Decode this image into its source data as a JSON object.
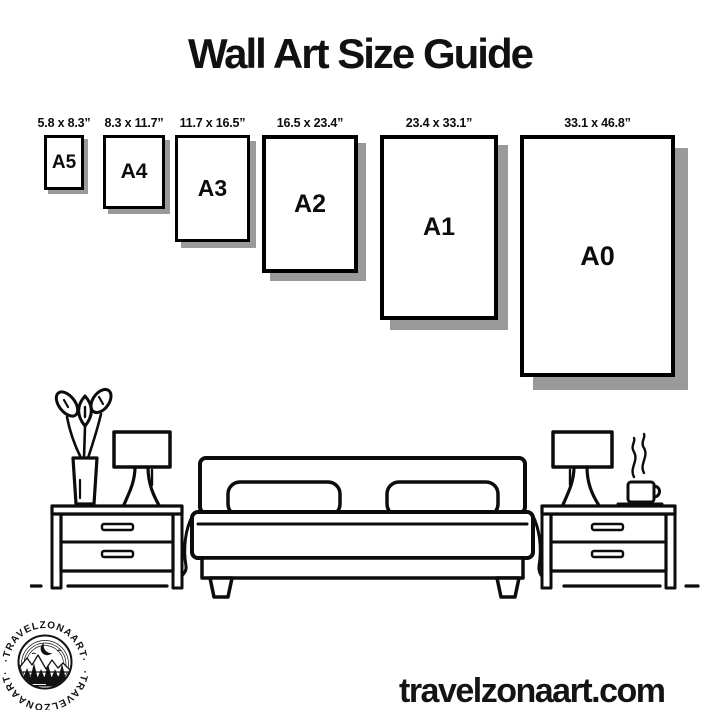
{
  "title": "Wall Art Size Guide",
  "website": "travelzonaart.com",
  "colors": {
    "ink": "#0f0f0f",
    "paper_border": "#000000",
    "shadow": "#9a9a9a",
    "background": "#ffffff"
  },
  "size_guide": {
    "items": [
      {
        "code": "A5",
        "inches": "5.8 x 8.3”",
        "x": 44,
        "y": 135,
        "w": 40,
        "h": 55,
        "shadow": 4,
        "border": 3,
        "code_px": 19
      },
      {
        "code": "A4",
        "inches": "8.3 x 11.7”",
        "x": 103,
        "y": 135,
        "w": 62,
        "h": 74,
        "shadow": 5,
        "border": 3,
        "code_px": 21
      },
      {
        "code": "A3",
        "inches": "11.7 x 16.5”",
        "x": 175,
        "y": 135,
        "w": 75,
        "h": 107,
        "shadow": 6,
        "border": 3,
        "code_px": 23
      },
      {
        "code": "A2",
        "inches": "16.5 x 23.4”",
        "x": 262,
        "y": 135,
        "w": 96,
        "h": 138,
        "shadow": 8,
        "border": 4,
        "code_px": 25
      },
      {
        "code": "A1",
        "inches": "23.4 x 33.1”",
        "x": 380,
        "y": 135,
        "w": 118,
        "h": 185,
        "shadow": 10,
        "border": 4,
        "code_px": 25
      },
      {
        "code": "A0",
        "inches": "33.1 x 46.8”",
        "x": 520,
        "y": 135,
        "w": 155,
        "h": 242,
        "shadow": 13,
        "border": 4,
        "code_px": 27
      }
    ]
  },
  "logo": {
    "arc_text_top": "·TRAVELZONAART·",
    "arc_text_bottom": "·TRAVELZONAART·"
  },
  "illustration": {
    "description": "bedroom line art: bed with two pillows, two nightstands, two table lamps, plant in vase, steaming coffee cup"
  }
}
